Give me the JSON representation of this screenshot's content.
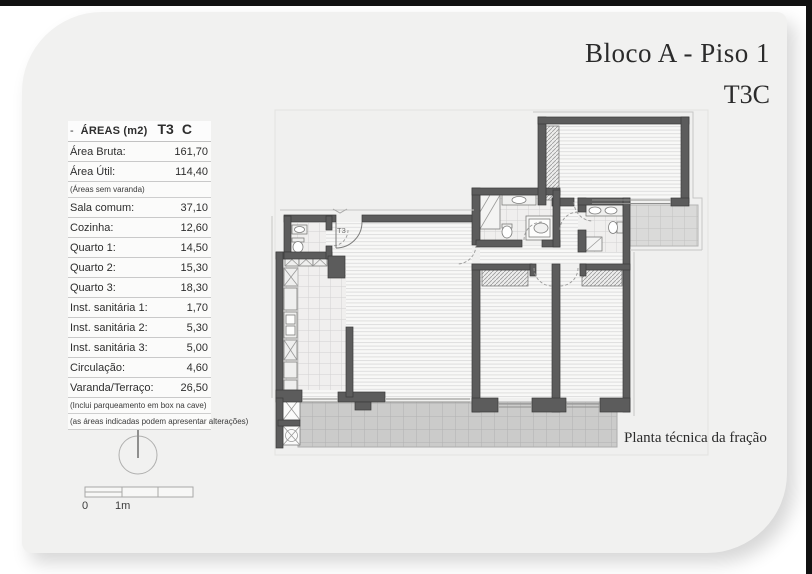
{
  "page": {
    "title_line1": "Bloco A - Piso 1",
    "title_line2": "T3C",
    "caption": "Planta técnica da fração"
  },
  "areas_table": {
    "header": {
      "dash": "-",
      "title": "ÁREAS (m2)",
      "type": "T3",
      "variant": "C"
    },
    "rows_top": [
      {
        "label": "Área Bruta:",
        "value": "161,70"
      },
      {
        "label": "Área Útil:",
        "value": "114,40"
      }
    ],
    "note_after_top": "(Áreas sem varanda)",
    "rows_main": [
      {
        "label": "Sala comum:",
        "value": "37,10"
      },
      {
        "label": "Cozinha:",
        "value": "12,60"
      },
      {
        "label": "Quarto 1:",
        "value": "14,50"
      },
      {
        "label": "Quarto 2:",
        "value": "15,30"
      },
      {
        "label": "Quarto 3:",
        "value": "18,30"
      },
      {
        "label": "Inst. sanitária 1:",
        "value": "1,70"
      },
      {
        "label": "Inst. sanitária 2:",
        "value": "5,30"
      },
      {
        "label": "Inst. sanitária 3:",
        "value": "5,00"
      },
      {
        "label": "Circulação:",
        "value": "4,60"
      },
      {
        "label": "Varanda/Terraço:",
        "value": "26,50"
      }
    ],
    "notes_bottom": [
      "(Inclui parqueamento em box na cave)",
      "(as áreas indicadas podem apresentar alterações)"
    ]
  },
  "compass": {
    "label": "N"
  },
  "scale_bar": {
    "zero": "0",
    "one": "1m"
  },
  "plan": {
    "entrance_label": "T3"
  },
  "colors": {
    "wall": "#5c5c5c",
    "page_bg": "#f1f1f0",
    "terrace_tile": "#cbcbca",
    "text": "#2b2b2b"
  }
}
